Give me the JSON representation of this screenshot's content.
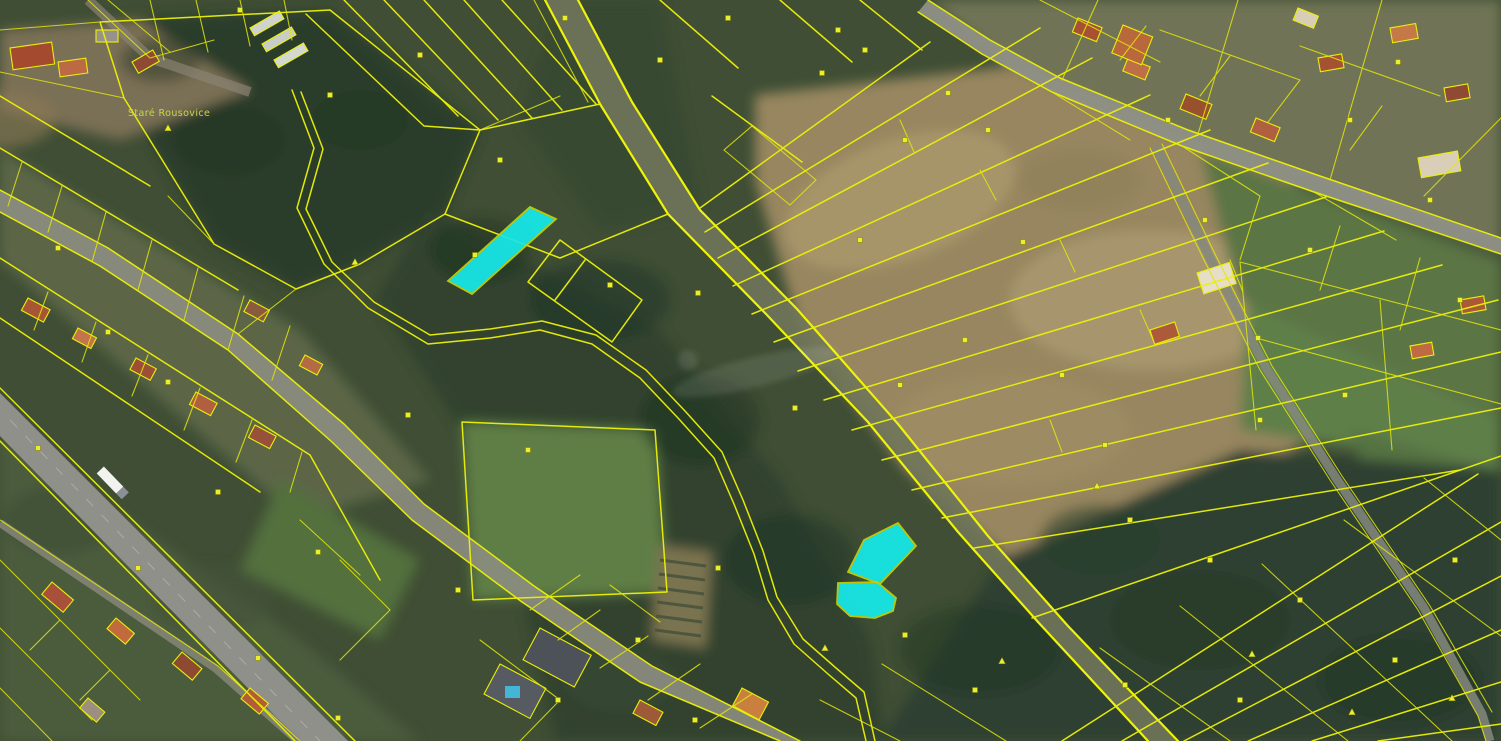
{
  "map": {
    "place_labels": [
      {
        "text": "Staré Rousovice"
      }
    ],
    "colors": {
      "parcel_line": "#eaef08",
      "highlight_fill": "#16e9e9",
      "highlight_stroke": "#c9cf00",
      "label_color": "#ccdc46",
      "road_fill": "#8f9084"
    },
    "highlight_parcels": [
      {
        "id": "parcel-highlight-1",
        "points": "530,207 556,219 472,294 448,281"
      },
      {
        "id": "parcel-highlight-2",
        "points": "898,523 916,546 880,584 848,572 864,540"
      },
      {
        "id": "parcel-highlight-3",
        "points": "838,583 877,582 896,598 893,611 875,618 850,616 837,604"
      }
    ],
    "square_markers": [
      [
        240,
        10
      ],
      [
        330,
        95
      ],
      [
        420,
        55
      ],
      [
        500,
        160
      ],
      [
        565,
        18
      ],
      [
        475,
        255
      ],
      [
        610,
        285
      ],
      [
        660,
        60
      ],
      [
        698,
        293
      ],
      [
        728,
        18
      ],
      [
        822,
        73
      ],
      [
        860,
        240
      ],
      [
        905,
        140
      ],
      [
        948,
        93
      ],
      [
        988,
        130
      ],
      [
        1023,
        242
      ],
      [
        965,
        340
      ],
      [
        900,
        385
      ],
      [
        1062,
        375
      ],
      [
        1105,
        445
      ],
      [
        1168,
        120
      ],
      [
        1205,
        220
      ],
      [
        1258,
        338
      ],
      [
        1310,
        250
      ],
      [
        1350,
        120
      ],
      [
        1398,
        62
      ],
      [
        1430,
        200
      ],
      [
        1460,
        300
      ],
      [
        1345,
        395
      ],
      [
        1260,
        420
      ],
      [
        1130,
        520
      ],
      [
        1210,
        560
      ],
      [
        1300,
        600
      ],
      [
        1395,
        660
      ],
      [
        1455,
        560
      ],
      [
        168,
        382
      ],
      [
        108,
        332
      ],
      [
        218,
        492
      ],
      [
        318,
        552
      ],
      [
        408,
        415
      ],
      [
        458,
        590
      ],
      [
        528,
        450
      ],
      [
        638,
        640
      ],
      [
        718,
        568
      ],
      [
        795,
        408
      ],
      [
        838,
        30
      ],
      [
        58,
        248
      ],
      [
        38,
        448
      ],
      [
        138,
        568
      ],
      [
        258,
        658
      ],
      [
        338,
        718
      ],
      [
        558,
        700
      ],
      [
        695,
        720
      ],
      [
        905,
        635
      ],
      [
        975,
        690
      ],
      [
        865,
        50
      ],
      [
        1125,
        685
      ],
      [
        1240,
        700
      ]
    ],
    "triangle_markers": [
      [
        355,
        262
      ],
      [
        168,
        128
      ],
      [
        1097,
        486
      ],
      [
        1252,
        654
      ],
      [
        1002,
        661
      ],
      [
        1352,
        712
      ],
      [
        1452,
        698
      ],
      [
        825,
        648
      ]
    ]
  }
}
